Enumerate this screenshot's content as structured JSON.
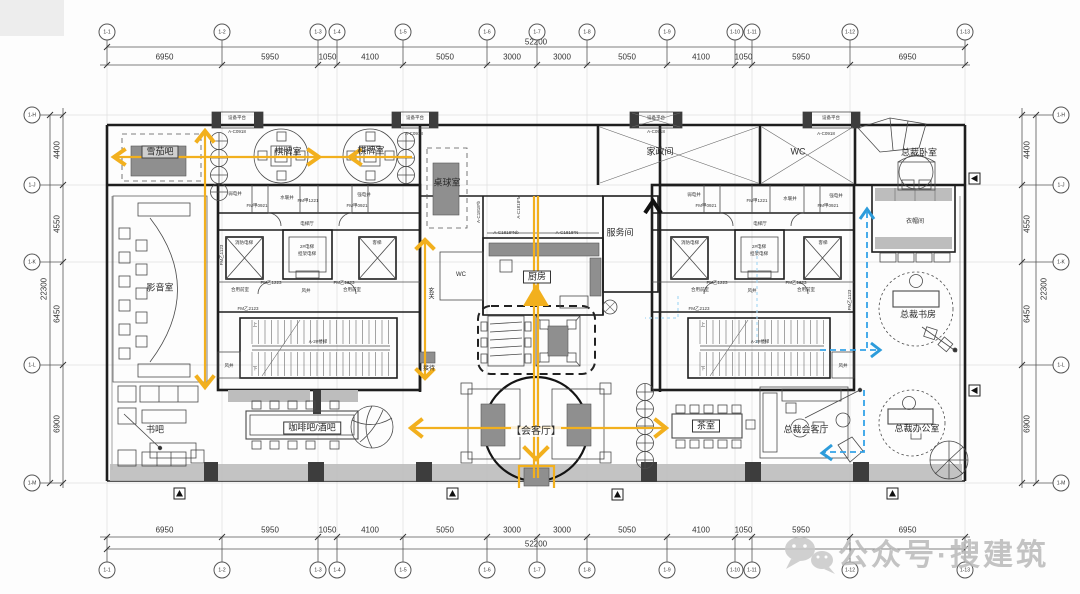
{
  "watermark": {
    "text": "公众号·搜建筑"
  },
  "axes": {
    "cols": [
      "1-1",
      "1-2",
      "1-3",
      "1-4",
      "1-5",
      "1-6",
      "1-7",
      "1-8",
      "1-9",
      "1-10",
      "1-11",
      "1-12",
      "1-13"
    ],
    "rows": [
      "1-H",
      "1-J",
      "1-K",
      "1-L",
      "1-M"
    ]
  },
  "dims": {
    "top": [
      "6950",
      "5950",
      "1050",
      "4100",
      "5050",
      "3000",
      "3000",
      "5050",
      "4100",
      "1050",
      "5950",
      "6950"
    ],
    "bottom": [
      "6950",
      "5950",
      "1050",
      "4100",
      "5050",
      "3000",
      "3000",
      "5050",
      "4100",
      "1050",
      "5950",
      "6950"
    ],
    "left": [
      "4400",
      "4550",
      "6450",
      "6900"
    ],
    "right": [
      "4400",
      "4550",
      "6450",
      "6900"
    ],
    "total_width": "52200",
    "total_height": "22300"
  },
  "rooms": {
    "cigar_bar": "雪茄吧",
    "chess_room_1": "棋牌室",
    "chess_room_2": "棋牌室",
    "billiards": "桌球室",
    "housekeeping": "家政间",
    "wc": "WC",
    "president_bedroom": "总裁卧室",
    "cloakroom": "衣帽间",
    "av_room": "影音室",
    "kitchen": "厨房",
    "service_room": "服务间",
    "foyer": "玄关",
    "reception": "接待",
    "wc_small": "WC",
    "president_study": "总裁书房",
    "book_bar": "书吧",
    "coffee_bar": "咖啡吧/酒吧",
    "living_room": "【会客厅】",
    "tea_room": "茶室",
    "president_lounge": "总裁会客厅",
    "president_office": "总裁办公室"
  },
  "core": {
    "weak_shaft": "弱电井",
    "strong_shaft": "强电井",
    "plumb_shaft": "水暖井",
    "elev_hall": "电梯厅",
    "fire_elev": "消防电梯",
    "pass_elev": "客梯",
    "elev_note1": "2#电梯",
    "elev_note2": "担架电梯",
    "shared_lobby": "合用前室",
    "air_shaft": "风井",
    "stair_label": "A-2#楼梯",
    "up": "上",
    "down": "下",
    "door_fm1221": "FM甲1221",
    "door_fm0921": "FM甲0921",
    "door_fm1223": "FM乙1223",
    "door_fm1123": "FM乙1123",
    "door_fm2123": "FM乙2123"
  },
  "annotations": {
    "platform": "设备平台",
    "win_c0918": "A-C0918",
    "win_c1818nb": "A-C1818*Nb",
    "win_c1818n": "A-C1818*N",
    "win_c1818b": "A-C1818*b",
    "win_c1818m": "A-C1818*M"
  }
}
